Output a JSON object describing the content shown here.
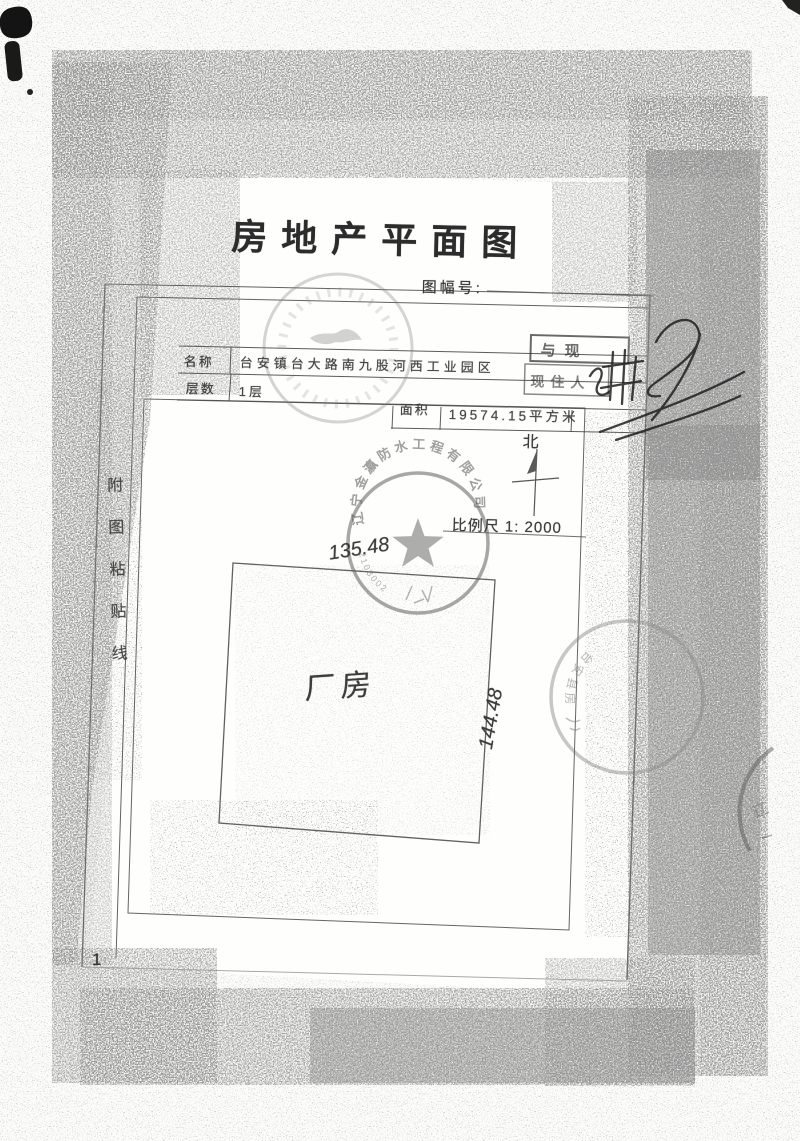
{
  "colors": {
    "ink": "#3a3a3a",
    "stamp_gray": "#7d7d7d",
    "paper": "#fcfcfa"
  },
  "document": {
    "title": "房地产平面图",
    "sheet_no_label": "图幅号:",
    "page_number": "1",
    "paste_line_text": "附图粘贴线",
    "table": {
      "name_label": "名称",
      "name_value": "台安镇台大路南九股河西工业园区",
      "floors_label": "层数",
      "floors_value": "1层",
      "area_label": "面积",
      "area_value": "19574.15平方米"
    },
    "compass": {
      "north_label": "北"
    },
    "scale_text": "比例尺 1: 2000",
    "plot": {
      "building_label": "厂房",
      "dim_top": "135.48",
      "dim_right": "144.48"
    },
    "review_box": {
      "line1": "与现",
      "line2": "现住人"
    },
    "seals": {
      "company_seal_arc": "辽宁金瀛防水工程有限公司",
      "company_seal_code": "2103002",
      "county_seal_arc": "台安县房",
      "corner_seal_char": "辽"
    }
  }
}
